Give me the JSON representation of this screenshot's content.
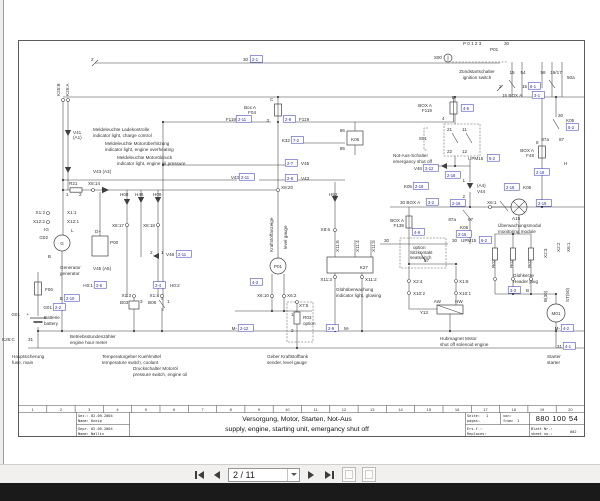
{
  "colors": {
    "ref_blue": "#2b2bb0",
    "line": "#3f3f3f",
    "page": "#ffffff",
    "chrome": "#f1f0ef",
    "dark_bar": "#1a1a1a"
  },
  "viewer": {
    "page_field": "2 / 11",
    "icons": {
      "first": "first-page-icon",
      "previous": "previous-page-icon",
      "next": "next-page-icon",
      "last": "last-page-icon",
      "previous_view": "previous-view-icon",
      "next_view": "next-view-icon"
    }
  },
  "titleblock": {
    "ruler": [
      "1",
      "2",
      "3",
      "4",
      "5",
      "6",
      "7",
      "8",
      "9",
      "10",
      "11",
      "12",
      "13",
      "14",
      "15",
      "16",
      "17",
      "18",
      "19",
      "20"
    ],
    "gez": "Gez.: 02.09.2004",
    "gez_name": "Name: Kneip",
    "gepr": "Gepr. 02.09.2004",
    "gepr_name": "Name: Nallin",
    "title_de": "Versorgung, Motor, Starten, Not-Aus",
    "title_en": "supply, engine, starting unit, emergancy shut off",
    "seite_label": "Seite:",
    "seite_value": "1",
    "von_label": "von:",
    "pages_label": "pages:",
    "from_label": "from:",
    "from_value": "1",
    "doc_number": "880 100 54",
    "ers_label": "Ers.f.:",
    "replaces_label": "Replaces:",
    "blatt_label": "Blatt Nr.:",
    "sheet_label": "sheet no.:",
    "sheet_value": "002"
  },
  "schematic": {
    "labels": [
      {
        "t": "2",
        "x": 91,
        "y": 61
      },
      {
        "t": "30",
        "x": 243,
        "y": 61
      },
      {
        "t": "2-1",
        "x": 252,
        "y": 61,
        "c": "ref"
      },
      {
        "t": "K25:B",
        "x": 60,
        "y": 96,
        "r": -90
      },
      {
        "t": "K25:A",
        "x": 69,
        "y": 96,
        "r": -90
      },
      {
        "t": "S00",
        "x": 442,
        "y": 59,
        "a": "end"
      },
      {
        "t": "P 0 1 2 3",
        "x": 463,
        "y": 45
      },
      {
        "t": "P01",
        "x": 490,
        "y": 51
      },
      {
        "t": "30",
        "x": 504,
        "y": 45
      },
      {
        "t": "Zündstartschalter",
        "x": 477,
        "y": 73,
        "a": "middle"
      },
      {
        "t": "ignition switch",
        "x": 477,
        "y": 79,
        "a": "middle"
      },
      {
        "t": "15",
        "x": 512,
        "y": 74,
        "a": "middle"
      },
      {
        "t": "54",
        "x": 523,
        "y": 74,
        "a": "middle"
      },
      {
        "t": "58",
        "x": 543,
        "y": 74,
        "a": "middle"
      },
      {
        "t": "19/17",
        "x": 556,
        "y": 74,
        "a": "middle"
      },
      {
        "t": "50a",
        "x": 567,
        "y": 79
      },
      {
        "t": "2",
        "x": 499,
        "y": 88
      },
      {
        "t": "15",
        "x": 522,
        "y": 88
      },
      {
        "t": "6-1",
        "x": 530,
        "y": 88,
        "c": "ref"
      },
      {
        "t": "15 BOX A",
        "x": 502,
        "y": 97
      },
      {
        "t": "3-1",
        "x": 534,
        "y": 97,
        "c": "ref"
      },
      {
        "t": "30",
        "x": 558,
        "y": 117
      },
      {
        "t": "K05",
        "x": 566,
        "y": 122
      },
      {
        "t": "5-2",
        "x": 568,
        "y": 129,
        "c": "ref"
      },
      {
        "t": "D",
        "x": 452,
        "y": 99
      },
      {
        "t": "BOX A",
        "x": 432,
        "y": 107,
        "a": "end"
      },
      {
        "t": "F119",
        "x": 432,
        "y": 112,
        "a": "end"
      },
      {
        "t": "4",
        "x": 442,
        "y": 120
      },
      {
        "t": "4-5",
        "x": 463,
        "y": 110,
        "c": "ref"
      },
      {
        "t": "C",
        "x": 270,
        "y": 101
      },
      {
        "t": "Box A",
        "x": 256,
        "y": 109,
        "a": "end"
      },
      {
        "t": "F04",
        "x": 256,
        "y": 114,
        "a": "end"
      },
      {
        "t": "3",
        "x": 269,
        "y": 122,
        "a": "end"
      },
      {
        "t": "F119",
        "x": 236,
        "y": 121,
        "a": "end"
      },
      {
        "t": "2-11",
        "x": 238,
        "y": 121,
        "c": "ref"
      },
      {
        "t": "2-9",
        "x": 285,
        "y": 121,
        "c": "ref"
      },
      {
        "t": "F119",
        "x": 299,
        "y": 121
      },
      {
        "t": "K32",
        "x": 290,
        "y": 142,
        "a": "end"
      },
      {
        "t": "7-2",
        "x": 293,
        "y": 142,
        "c": "ref"
      },
      {
        "t": "2-7",
        "x": 287,
        "y": 165,
        "c": "ref"
      },
      {
        "t": "V45",
        "x": 301,
        "y": 165
      },
      {
        "t": "2-8",
        "x": 287,
        "y": 180,
        "c": "ref"
      },
      {
        "t": "V43",
        "x": 301,
        "y": 180
      },
      {
        "t": "V43",
        "x": 239,
        "y": 179,
        "a": "end"
      },
      {
        "t": "2-11",
        "x": 241,
        "y": 179,
        "c": "ref"
      },
      {
        "t": "X8:20",
        "x": 281,
        "y": 189
      },
      {
        "t": "Meldeleuchte Ladekontrolle",
        "x": 93,
        "y": 131
      },
      {
        "t": "indicator light, charge control",
        "x": 93,
        "y": 137
      },
      {
        "t": "Meldeleuchte Motorüberhitzung",
        "x": 105,
        "y": 145
      },
      {
        "t": "indicator light, engine overheating",
        "x": 105,
        "y": 151
      },
      {
        "t": "Meldeleuchte Motoröldruck",
        "x": 117,
        "y": 159
      },
      {
        "t": "indicator light, engine oil pressure",
        "x": 117,
        "y": 165
      },
      {
        "t": "V41",
        "x": 73,
        "y": 134
      },
      {
        "t": "(A1)",
        "x": 73,
        "y": 139
      },
      {
        "t": "V43 (A3)",
        "x": 93,
        "y": 173
      },
      {
        "t": "R21",
        "x": 69,
        "y": 185
      },
      {
        "t": "X8:14",
        "x": 88,
        "y": 185
      },
      {
        "t": "1",
        "x": 66,
        "y": 196
      },
      {
        "t": "2",
        "x": 79,
        "y": 196
      },
      {
        "t": "H08",
        "x": 120,
        "y": 196
      },
      {
        "t": "H48",
        "x": 135,
        "y": 196
      },
      {
        "t": "H09",
        "x": 153,
        "y": 196
      },
      {
        "t": "X8:17",
        "x": 124,
        "y": 227,
        "a": "end"
      },
      {
        "t": "X8:18",
        "x": 155,
        "y": 227,
        "a": "end"
      },
      {
        "t": "X1:2",
        "x": 45,
        "y": 214,
        "a": "end"
      },
      {
        "t": "X12:2",
        "x": 45,
        "y": 223,
        "a": "end"
      },
      {
        "t": "X1:1",
        "x": 67,
        "y": 214
      },
      {
        "t": "X12:1",
        "x": 67,
        "y": 223
      },
      {
        "t": "IG",
        "x": 49,
        "y": 231,
        "a": "end"
      },
      {
        "t": "L",
        "x": 71,
        "y": 232
      },
      {
        "t": "G02",
        "x": 48,
        "y": 239,
        "a": "end"
      },
      {
        "t": "B",
        "x": 51,
        "y": 258,
        "a": "end"
      },
      {
        "t": "D+",
        "x": 95,
        "y": 233
      },
      {
        "t": "P00",
        "x": 110,
        "y": 244
      },
      {
        "t": "Generator",
        "x": 60,
        "y": 269
      },
      {
        "t": "generator",
        "x": 60,
        "y": 275
      },
      {
        "t": "V45 (A5)",
        "x": 93,
        "y": 270
      },
      {
        "t": "2",
        "x": 150,
        "y": 254
      },
      {
        "t": "1",
        "x": 161,
        "y": 254
      },
      {
        "t": "V46",
        "x": 166,
        "y": 256
      },
      {
        "t": "2-11",
        "x": 178,
        "y": 256,
        "c": "ref"
      },
      {
        "t": "H0:1",
        "x": 93,
        "y": 287,
        "a": "end"
      },
      {
        "t": "2-6",
        "x": 96,
        "y": 287,
        "c": "ref"
      },
      {
        "t": "2-4",
        "x": 155,
        "y": 287,
        "c": "ref"
      },
      {
        "t": "H0:2",
        "x": 170,
        "y": 287
      },
      {
        "t": "X1:3",
        "x": 131,
        "y": 297,
        "a": "end"
      },
      {
        "t": "X1:4",
        "x": 159,
        "y": 297,
        "a": "end"
      },
      {
        "t": "B03",
        "x": 120,
        "y": 304
      },
      {
        "t": "3",
        "x": 140,
        "y": 303
      },
      {
        "t": "B06",
        "x": 148,
        "y": 304
      },
      {
        "t": "1",
        "x": 167,
        "y": 303
      },
      {
        "t": "F06",
        "x": 45,
        "y": 291
      },
      {
        "t": "+",
        "x": 29,
        "y": 316,
        "a": "end"
      },
      {
        "t": "G01",
        "x": 20,
        "y": 316,
        "a": "end"
      },
      {
        "t": "Batterie",
        "x": 44,
        "y": 319
      },
      {
        "t": "battery",
        "x": 44,
        "y": 325
      },
      {
        "t": "K26:C",
        "x": 2,
        "y": 341
      },
      {
        "t": "31",
        "x": 28,
        "y": 341
      },
      {
        "t": "B",
        "x": 63,
        "y": 300,
        "a": "end"
      },
      {
        "t": "2-10",
        "x": 66,
        "y": 300,
        "c": "ref"
      },
      {
        "t": "G01",
        "x": 52,
        "y": 309,
        "a": "end"
      },
      {
        "t": "2-2",
        "x": 55,
        "y": 309,
        "c": "ref"
      },
      {
        "t": "Hauptsicherung",
        "x": 12,
        "y": 358
      },
      {
        "t": "fuse, main",
        "x": 12,
        "y": 364
      },
      {
        "t": "Betriebsstundenzähler",
        "x": 70,
        "y": 338
      },
      {
        "t": "engine hour meter",
        "x": 70,
        "y": 344
      },
      {
        "t": "Temperaturgeber Kuehlmittel",
        "x": 102,
        "y": 358
      },
      {
        "t": "temperature switch, coolant",
        "x": 102,
        "y": 364
      },
      {
        "t": "Druckschalter Motoröl",
        "x": 133,
        "y": 370
      },
      {
        "t": "pressure switch, engine oil",
        "x": 133,
        "y": 376
      },
      {
        "t": "Kraftstoffanzeige",
        "x": 273,
        "y": 252,
        "r": -90
      },
      {
        "t": "level gauge",
        "x": 287,
        "y": 249,
        "r": -90
      },
      {
        "t": "P01",
        "x": 278,
        "y": 268,
        "a": "middle"
      },
      {
        "t": "X6:10",
        "x": 269,
        "y": 297,
        "a": "end"
      },
      {
        "t": "X6:2",
        "x": 287,
        "y": 297
      },
      {
        "t": "4-3",
        "x": 252,
        "y": 284,
        "c": "ref"
      },
      {
        "t": "X7:5",
        "x": 299,
        "y": 307
      },
      {
        "t": "1",
        "x": 291,
        "y": 316
      },
      {
        "t": "R03",
        "x": 303,
        "y": 319
      },
      {
        "t": "option",
        "x": 303,
        "y": 325
      },
      {
        "t": "2",
        "x": 291,
        "y": 332
      },
      {
        "t": "Geber Kraftstofftank",
        "x": 267,
        "y": 358
      },
      {
        "t": "sender, level gauge",
        "x": 267,
        "y": 364
      },
      {
        "t": "M-",
        "x": 237,
        "y": 330,
        "a": "end"
      },
      {
        "t": "2-12",
        "x": 240,
        "y": 330,
        "c": "ref"
      },
      {
        "t": "2-9",
        "x": 328,
        "y": 330,
        "c": "ref"
      },
      {
        "t": "M-",
        "x": 344,
        "y": 330
      },
      {
        "t": "H52",
        "x": 329,
        "y": 196
      },
      {
        "t": "X8:6",
        "x": 330,
        "y": 231,
        "a": "end"
      },
      {
        "t": "X11:6",
        "x": 339,
        "y": 252,
        "r": -90
      },
      {
        "t": "X11:4",
        "x": 359,
        "y": 252,
        "r": -90
      },
      {
        "t": "X11:5",
        "x": 375,
        "y": 252,
        "r": -90
      },
      {
        "t": "K27",
        "x": 368,
        "y": 269,
        "a": "end"
      },
      {
        "t": "X11:3",
        "x": 332,
        "y": 281,
        "a": "end"
      },
      {
        "t": "X11:2",
        "x": 365,
        "y": 281
      },
      {
        "t": "Glühüberwachung",
        "x": 336,
        "y": 291
      },
      {
        "t": "indicator light, glowing",
        "x": 336,
        "y": 297
      },
      {
        "t": "86",
        "x": 345,
        "y": 132,
        "a": "end"
      },
      {
        "t": "K06",
        "x": 351,
        "y": 141
      },
      {
        "t": "85",
        "x": 345,
        "y": 150,
        "a": "end"
      },
      {
        "t": "S01",
        "x": 427,
        "y": 140,
        "a": "end"
      },
      {
        "t": "21",
        "x": 447,
        "y": 131
      },
      {
        "t": "11",
        "x": 462,
        "y": 131
      },
      {
        "t": "22",
        "x": 447,
        "y": 153
      },
      {
        "t": "12",
        "x": 462,
        "y": 153
      },
      {
        "t": "Not-Aus-Schalter",
        "x": 393,
        "y": 157
      },
      {
        "t": "emergancy shut off",
        "x": 393,
        "y": 163
      },
      {
        "t": "V46",
        "x": 422,
        "y": 170,
        "a": "end"
      },
      {
        "t": "2-12",
        "x": 425,
        "y": 170,
        "c": "ref"
      },
      {
        "t": "UPM15",
        "x": 468,
        "y": 160
      },
      {
        "t": "5-2",
        "x": 489,
        "y": 160,
        "c": "ref"
      },
      {
        "t": "2-16",
        "x": 447,
        "y": 177,
        "c": "ref"
      },
      {
        "t": "K05",
        "x": 412,
        "y": 188,
        "a": "end"
      },
      {
        "t": "2-18",
        "x": 415,
        "y": 188,
        "c": "ref"
      },
      {
        "t": "2-18",
        "x": 506,
        "y": 189,
        "c": "ref"
      },
      {
        "t": "K05",
        "x": 523,
        "y": 189
      },
      {
        "t": "H",
        "x": 564,
        "y": 165
      },
      {
        "t": "2-18",
        "x": 536,
        "y": 174,
        "c": "ref"
      },
      {
        "t": "30 BOX A",
        "x": 400,
        "y": 204
      },
      {
        "t": "3-2",
        "x": 428,
        "y": 204,
        "c": "ref"
      },
      {
        "t": "BOX A",
        "x": 404,
        "y": 222,
        "a": "end"
      },
      {
        "t": "F139",
        "x": 404,
        "y": 227,
        "a": "end"
      },
      {
        "t": "4-9",
        "x": 414,
        "y": 234,
        "c": "ref"
      },
      {
        "t": "30",
        "x": 384,
        "y": 242
      },
      {
        "t": "option",
        "x": 413,
        "y": 249
      },
      {
        "t": "Sitzkontakt",
        "x": 410,
        "y": 254
      },
      {
        "t": "seatswitch",
        "x": 410,
        "y": 259
      },
      {
        "t": "87",
        "x": 424,
        "y": 262
      },
      {
        "t": "(A4)",
        "x": 477,
        "y": 187
      },
      {
        "t": "V44",
        "x": 477,
        "y": 193
      },
      {
        "t": "1",
        "x": 465,
        "y": 182,
        "a": "end"
      },
      {
        "t": "2",
        "x": 465,
        "y": 198,
        "a": "end"
      },
      {
        "t": "2-16",
        "x": 452,
        "y": 205,
        "c": "ref"
      },
      {
        "t": "X6:1",
        "x": 487,
        "y": 204
      },
      {
        "t": "A15",
        "x": 512,
        "y": 220
      },
      {
        "t": "Überwachungsmodul",
        "x": 498,
        "y": 227
      },
      {
        "t": "monitoring module",
        "x": 498,
        "y": 233
      },
      {
        "t": "87a",
        "x": 456,
        "y": 221,
        "a": "end"
      },
      {
        "t": "87",
        "x": 468,
        "y": 221
      },
      {
        "t": "K06",
        "x": 460,
        "y": 229
      },
      {
        "t": "2-15",
        "x": 458,
        "y": 236,
        "c": "ref"
      },
      {
        "t": "2-19",
        "x": 538,
        "y": 205,
        "c": "ref"
      },
      {
        "t": "30",
        "x": 452,
        "y": 242
      },
      {
        "t": "UPM15",
        "x": 461,
        "y": 242
      },
      {
        "t": "6-2",
        "x": 481,
        "y": 242,
        "c": "ref"
      },
      {
        "t": "R02",
        "x": 495,
        "y": 268,
        "r": -90
      },
      {
        "t": "R02",
        "x": 513,
        "y": 268,
        "r": -90
      },
      {
        "t": "R02",
        "x": 531,
        "y": 268,
        "r": -90
      },
      {
        "t": "X2:3",
        "x": 547,
        "y": 258,
        "r": -90
      },
      {
        "t": "X2:2",
        "x": 560,
        "y": 252,
        "r": -90
      },
      {
        "t": "X6:1",
        "x": 570,
        "y": 252,
        "r": -90
      },
      {
        "t": "BOX A",
        "x": 534,
        "y": 152,
        "a": "end"
      },
      {
        "t": "F48",
        "x": 534,
        "y": 157,
        "a": "end"
      },
      {
        "t": "8",
        "x": 536,
        "y": 144
      },
      {
        "t": "87a",
        "x": 549,
        "y": 141,
        "a": "end"
      },
      {
        "t": "87",
        "x": 559,
        "y": 141
      },
      {
        "t": "X2:4",
        "x": 413,
        "y": 283
      },
      {
        "t": "X10:2",
        "x": 413,
        "y": 295
      },
      {
        "t": "X1:6",
        "x": 459,
        "y": 283
      },
      {
        "t": "X10:1",
        "x": 459,
        "y": 295
      },
      {
        "t": "AW",
        "x": 441,
        "y": 303,
        "a": "end"
      },
      {
        "t": "HW",
        "x": 455,
        "y": 303
      },
      {
        "t": "Y13",
        "x": 428,
        "y": 314,
        "a": "end"
      },
      {
        "t": "Hubmagnet Motor",
        "x": 440,
        "y": 340
      },
      {
        "t": "shut off solenoid engine",
        "x": 440,
        "y": 346
      },
      {
        "t": "Glühkerze",
        "x": 513,
        "y": 277
      },
      {
        "t": "Header plug",
        "x": 513,
        "y": 283
      },
      {
        "t": "3-3",
        "x": 510,
        "y": 292,
        "c": "ref"
      },
      {
        "t": "B",
        "x": 526,
        "y": 292
      },
      {
        "t": "B(30)",
        "x": 547,
        "y": 302,
        "r": -90
      },
      {
        "t": "ST(50)",
        "x": 569,
        "y": 302,
        "r": -90
      },
      {
        "t": "M01",
        "x": 556,
        "y": 315,
        "a": "middle"
      },
      {
        "t": "M-",
        "x": 560,
        "y": 330,
        "a": "end"
      },
      {
        "t": "4-2",
        "x": 563,
        "y": 330,
        "c": "ref"
      },
      {
        "t": "31",
        "x": 562,
        "y": 348,
        "a": "end"
      },
      {
        "t": "4-1",
        "x": 565,
        "y": 348,
        "c": "ref"
      },
      {
        "t": "Starter",
        "x": 547,
        "y": 358
      },
      {
        "t": "starter",
        "x": 547,
        "y": 364
      },
      {
        "t": "G",
        "x": 62,
        "y": 245,
        "a": "middle"
      }
    ]
  }
}
